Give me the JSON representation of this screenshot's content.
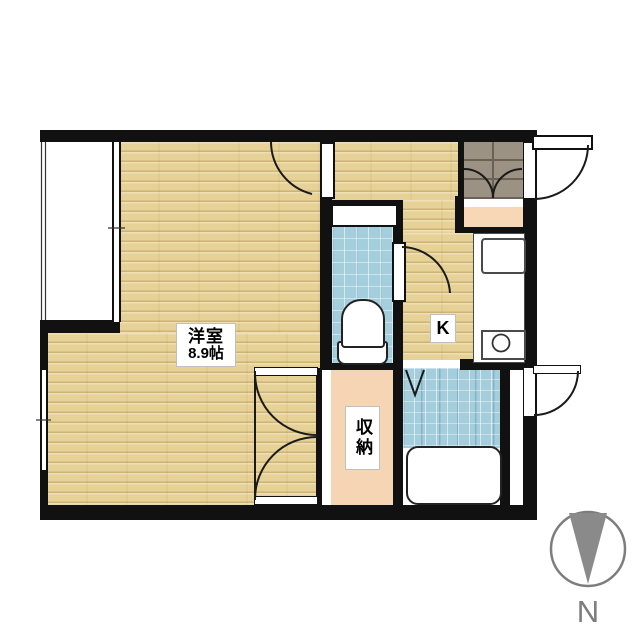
{
  "labels": {
    "main_room": {
      "name": "洋室",
      "area": "8.9帖"
    },
    "kitchen": "K",
    "closet": "収納",
    "compass_north": "N"
  },
  "rooms": [
    {
      "name": "western-room",
      "label": "洋室 8.9帖",
      "floor": "wood"
    },
    {
      "name": "kitchen",
      "label": "K",
      "floor": "wood"
    },
    {
      "name": "closet",
      "label": "収納",
      "floor": "peach"
    },
    {
      "name": "toilet",
      "label": "",
      "floor": "blue-tile"
    },
    {
      "name": "bathroom",
      "label": "",
      "floor": "blue-tile"
    },
    {
      "name": "entrance",
      "label": "",
      "floor": "gray-tile"
    },
    {
      "name": "balcony",
      "label": "",
      "floor": "white"
    }
  ],
  "colors": {
    "wall": "#111111",
    "wood_floor": "#ead69c",
    "tile_blue": "#a5cedd",
    "entrance_tile": "#9b9284",
    "step_peach": "#f7d7b6",
    "closet_peach": "#f6d5b4",
    "fixture_outline": "#222222",
    "compass_gray": "#8a8a8a",
    "linework": "#1a1a1a"
  }
}
